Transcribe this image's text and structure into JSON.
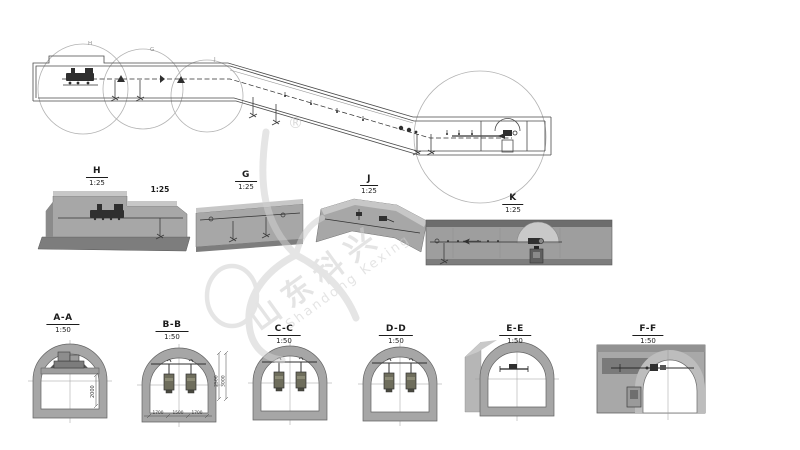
{
  "watermark": {
    "registered_mark": "®",
    "brand_cn": "山东科兴",
    "brand_en": "Shandong Kexing"
  },
  "plan": {
    "callout_h": "H",
    "callout_g": "G",
    "callout_j": "J",
    "scale_note": "1:25"
  },
  "details": {
    "h": {
      "id": "H",
      "scale": "1:25"
    },
    "g": {
      "id": "G",
      "scale": "1:25"
    },
    "j": {
      "id": "J",
      "scale": "1:25"
    },
    "k": {
      "id": "K",
      "scale": "1:25"
    }
  },
  "cross_sections": {
    "aa": {
      "id": "A-A",
      "scale": "1:50",
      "dim_height": "2000"
    },
    "bb": {
      "id": "B-B",
      "scale": "1:50",
      "dim_right_outer": "3000",
      "dim_right_inner": "2500",
      "dim_bottom": [
        "1700",
        "1500",
        "1700"
      ]
    },
    "cc": {
      "id": "C-C",
      "scale": "1:50"
    },
    "dd": {
      "id": "D-D",
      "scale": "1:50"
    },
    "ee": {
      "id": "E-E",
      "scale": "1:50"
    },
    "ff": {
      "id": "F-F",
      "scale": "1:50"
    }
  },
  "colors": {
    "line": "#4a4a4a",
    "ring_fill": "#a6a6a6",
    "slab_light": "#c7c7c7",
    "slab_mid": "#a7a7a7",
    "slab_dark": "#7d7d7d",
    "watermark": "#cfcfcf"
  }
}
